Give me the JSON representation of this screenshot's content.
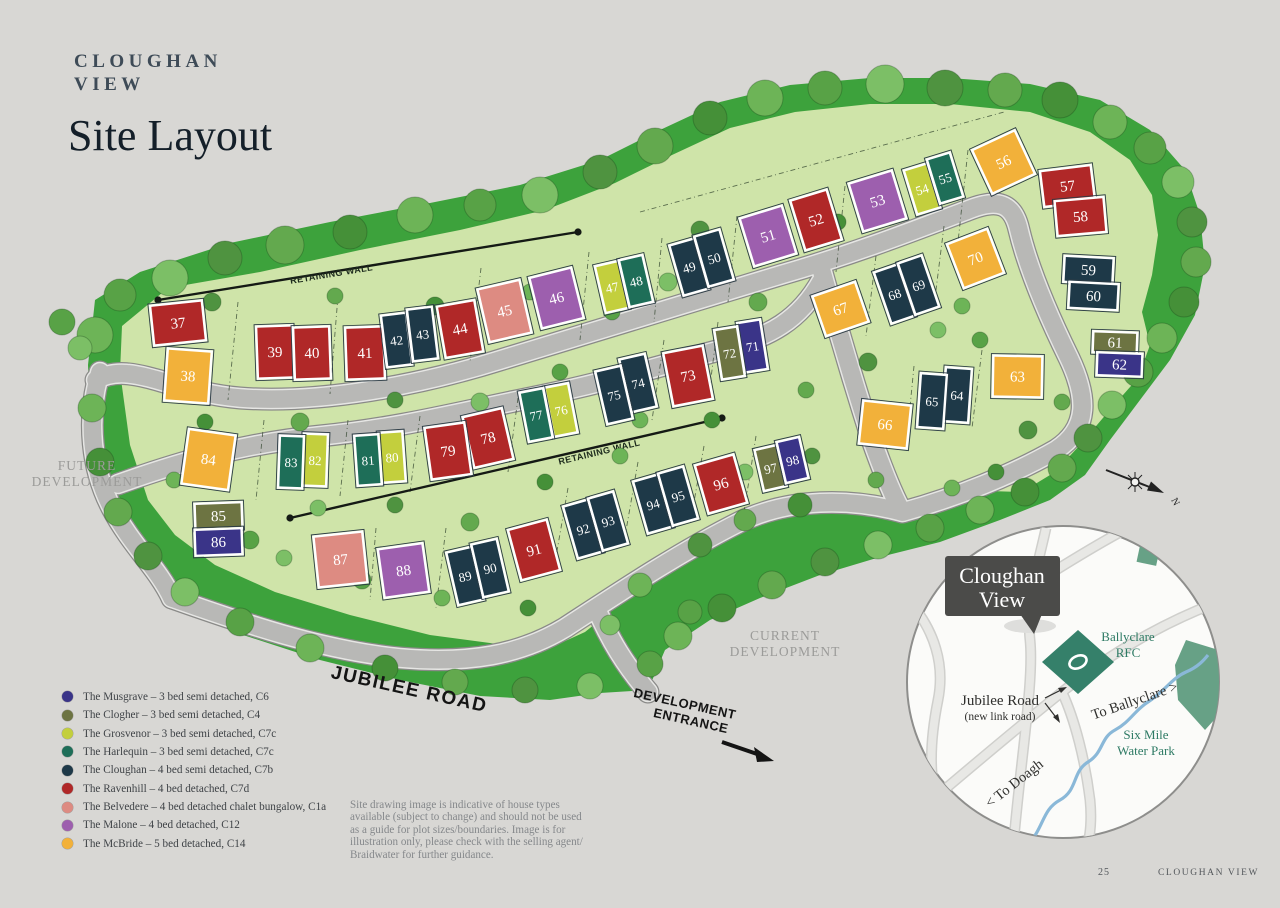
{
  "header": {
    "brand_line1": "CLOUGHAN",
    "brand_line2": "VIEW",
    "page_title": "Site Layout"
  },
  "site_labels": {
    "retaining_wall_upper": "RETAINING WALL",
    "retaining_wall_lower": "RETAINING WALL",
    "future_development_line1": "FUTURE",
    "future_development_line2": "DEVELOPMENT",
    "current_development_line1": "CURRENT",
    "current_development_line2": "DEVELOPMENT",
    "jubilee_road": "JUBILEE ROAD",
    "development_entrance_line1": "DEVELOPMENT",
    "development_entrance_line2": "ENTRANCE",
    "compass_north": "N"
  },
  "house_types": {
    "musgrave": {
      "label": "The Musgrave – 3 bed semi detached, C6",
      "color": "#3a3488"
    },
    "clogher": {
      "label": "The Clogher – 3 bed semi detached, C4",
      "color": "#6d7442"
    },
    "grosvenor": {
      "label": "The Grosvenor – 3 bed semi detached, C7c",
      "color": "#c3cf3d"
    },
    "harlequin": {
      "label": "The Harlequin – 3 bed semi detached, C7c",
      "color": "#1e6e58"
    },
    "cloughan": {
      "label": "The Cloughan – 4 bed semi detached, C7b",
      "color": "#1e3948"
    },
    "ravenhill": {
      "label": "The Ravenhill – 4 bed detached, C7d",
      "color": "#b02828"
    },
    "belvedere": {
      "label": "The Belvedere – 4 bed detached chalet bungalow, C1a",
      "color": "#dd8b82"
    },
    "malone": {
      "label": "The Malone – 4 bed detached, C12",
      "color": "#9d5fae"
    },
    "mcbride": {
      "label": "The McBride – 5 bed detached, C14",
      "color": "#f2b13a"
    }
  },
  "legend_order": [
    "musgrave",
    "clogher",
    "grosvenor",
    "harlequin",
    "cloughan",
    "ravenhill",
    "belvedere",
    "malone",
    "mcbride"
  ],
  "plots": [
    {
      "n": 37,
      "t": "ravenhill",
      "x": 152,
      "y": 303,
      "w": 52,
      "h": 40,
      "r": -6
    },
    {
      "n": 38,
      "t": "mcbride",
      "x": 166,
      "y": 350,
      "w": 44,
      "h": 52,
      "r": 4
    },
    {
      "n": 39,
      "t": "ravenhill",
      "x": 257,
      "y": 326,
      "w": 36,
      "h": 52,
      "r": -2
    },
    {
      "n": 40,
      "t": "ravenhill",
      "x": 294,
      "y": 327,
      "w": 36,
      "h": 52,
      "r": -2
    },
    {
      "n": 41,
      "t": "ravenhill",
      "x": 346,
      "y": 327,
      "w": 38,
      "h": 52,
      "r": -2
    },
    {
      "n": 42,
      "t": "cloughan",
      "x": 384,
      "y": 314,
      "w": 25,
      "h": 52,
      "r": -7
    },
    {
      "n": 43,
      "t": "cloughan",
      "x": 410,
      "y": 308,
      "w": 25,
      "h": 52,
      "r": -7
    },
    {
      "n": 44,
      "t": "ravenhill",
      "x": 441,
      "y": 303,
      "w": 38,
      "h": 52,
      "r": -10
    },
    {
      "n": 45,
      "t": "belvedere",
      "x": 483,
      "y": 284,
      "w": 43,
      "h": 54,
      "r": -13
    },
    {
      "n": 46,
      "t": "malone",
      "x": 535,
      "y": 272,
      "w": 43,
      "h": 52,
      "r": -14
    },
    {
      "n": 47,
      "t": "grosvenor",
      "x": 600,
      "y": 263,
      "w": 24,
      "h": 48,
      "r": -13
    },
    {
      "n": 48,
      "t": "harlequin",
      "x": 624,
      "y": 257,
      "w": 24,
      "h": 48,
      "r": -13
    },
    {
      "n": 49,
      "t": "cloughan",
      "x": 676,
      "y": 241,
      "w": 26,
      "h": 52,
      "r": -16
    },
    {
      "n": 50,
      "t": "cloughan",
      "x": 701,
      "y": 232,
      "w": 26,
      "h": 52,
      "r": -16
    },
    {
      "n": 51,
      "t": "malone",
      "x": 746,
      "y": 211,
      "w": 44,
      "h": 50,
      "r": -17
    },
    {
      "n": 52,
      "t": "ravenhill",
      "x": 797,
      "y": 194,
      "w": 38,
      "h": 52,
      "r": -17
    },
    {
      "n": 53,
      "t": "malone",
      "x": 855,
      "y": 176,
      "w": 45,
      "h": 50,
      "r": -17
    },
    {
      "n": 54,
      "t": "grosvenor",
      "x": 910,
      "y": 166,
      "w": 24,
      "h": 46,
      "r": -17
    },
    {
      "n": 55,
      "t": "harlequin",
      "x": 933,
      "y": 155,
      "w": 24,
      "h": 46,
      "r": -17
    },
    {
      "n": 56,
      "t": "mcbride",
      "x": 980,
      "y": 138,
      "w": 47,
      "h": 48,
      "r": -25
    },
    {
      "n": 57,
      "t": "ravenhill",
      "x": 1042,
      "y": 168,
      "w": 51,
      "h": 36,
      "r": -7
    },
    {
      "n": 58,
      "t": "ravenhill",
      "x": 1056,
      "y": 199,
      "w": 49,
      "h": 35,
      "r": -5
    },
    {
      "n": 59,
      "t": "cloughan",
      "x": 1064,
      "y": 257,
      "w": 49,
      "h": 26,
      "r": 3
    },
    {
      "n": 60,
      "t": "cloughan",
      "x": 1069,
      "y": 283,
      "w": 49,
      "h": 26,
      "r": 3
    },
    {
      "n": 61,
      "t": "clogher",
      "x": 1093,
      "y": 332,
      "w": 44,
      "h": 21,
      "r": 2
    },
    {
      "n": 62,
      "t": "musgrave",
      "x": 1097,
      "y": 353,
      "w": 45,
      "h": 23,
      "r": 2
    },
    {
      "n": 63,
      "t": "mcbride",
      "x": 993,
      "y": 356,
      "w": 49,
      "h": 41,
      "r": 1
    },
    {
      "n": 64,
      "t": "cloughan",
      "x": 944,
      "y": 368,
      "w": 26,
      "h": 54,
      "r": 4
    },
    {
      "n": 65,
      "t": "cloughan",
      "x": 919,
      "y": 374,
      "w": 26,
      "h": 54,
      "r": 4
    },
    {
      "n": 66,
      "t": "mcbride",
      "x": 861,
      "y": 403,
      "w": 48,
      "h": 43,
      "r": 6
    },
    {
      "n": 67,
      "t": "mcbride",
      "x": 818,
      "y": 288,
      "w": 45,
      "h": 42,
      "r": -19
    },
    {
      "n": 68,
      "t": "cloughan",
      "x": 882,
      "y": 267,
      "w": 25,
      "h": 54,
      "r": -19
    },
    {
      "n": 69,
      "t": "cloughan",
      "x": 906,
      "y": 258,
      "w": 25,
      "h": 54,
      "r": -19
    },
    {
      "n": 70,
      "t": "mcbride",
      "x": 954,
      "y": 235,
      "w": 43,
      "h": 47,
      "r": -21
    },
    {
      "n": 71,
      "t": "musgrave",
      "x": 741,
      "y": 321,
      "w": 23,
      "h": 50,
      "r": -9
    },
    {
      "n": 72,
      "t": "clogher",
      "x": 718,
      "y": 328,
      "w": 23,
      "h": 50,
      "r": -9
    },
    {
      "n": 73,
      "t": "ravenhill",
      "x": 668,
      "y": 349,
      "w": 40,
      "h": 54,
      "r": -11
    },
    {
      "n": 74,
      "t": "cloughan",
      "x": 625,
      "y": 356,
      "w": 26,
      "h": 54,
      "r": -13
    },
    {
      "n": 75,
      "t": "cloughan",
      "x": 601,
      "y": 368,
      "w": 26,
      "h": 54,
      "r": -13
    },
    {
      "n": 76,
      "t": "grosvenor",
      "x": 549,
      "y": 385,
      "w": 24,
      "h": 50,
      "r": -11
    },
    {
      "n": 77,
      "t": "harlequin",
      "x": 524,
      "y": 390,
      "w": 24,
      "h": 50,
      "r": -11
    },
    {
      "n": 78,
      "t": "ravenhill",
      "x": 468,
      "y": 412,
      "w": 40,
      "h": 52,
      "r": -13
    },
    {
      "n": 79,
      "t": "ravenhill",
      "x": 428,
      "y": 425,
      "w": 40,
      "h": 52,
      "r": -8
    },
    {
      "n": 80,
      "t": "grosvenor",
      "x": 380,
      "y": 432,
      "w": 24,
      "h": 50,
      "r": -4
    },
    {
      "n": 81,
      "t": "harlequin",
      "x": 356,
      "y": 435,
      "w": 24,
      "h": 50,
      "r": -4
    },
    {
      "n": 82,
      "t": "grosvenor",
      "x": 303,
      "y": 434,
      "w": 24,
      "h": 52,
      "r": 2
    },
    {
      "n": 83,
      "t": "harlequin",
      "x": 279,
      "y": 436,
      "w": 24,
      "h": 52,
      "r": 2
    },
    {
      "n": 84,
      "t": "mcbride",
      "x": 185,
      "y": 432,
      "w": 47,
      "h": 55,
      "r": 8
    },
    {
      "n": 85,
      "t": "clogher",
      "x": 195,
      "y": 503,
      "w": 47,
      "h": 26,
      "r": -2
    },
    {
      "n": 86,
      "t": "musgrave",
      "x": 195,
      "y": 529,
      "w": 47,
      "h": 26,
      "r": -2
    },
    {
      "n": 87,
      "t": "belvedere",
      "x": 316,
      "y": 534,
      "w": 49,
      "h": 51,
      "r": -6
    },
    {
      "n": 88,
      "t": "malone",
      "x": 381,
      "y": 546,
      "w": 45,
      "h": 49,
      "r": -8
    },
    {
      "n": 89,
      "t": "cloughan",
      "x": 452,
      "y": 549,
      "w": 26,
      "h": 54,
      "r": -13
    },
    {
      "n": 90,
      "t": "cloughan",
      "x": 477,
      "y": 541,
      "w": 26,
      "h": 54,
      "r": -13
    },
    {
      "n": 91,
      "t": "ravenhill",
      "x": 514,
      "y": 524,
      "w": 40,
      "h": 52,
      "r": -15
    },
    {
      "n": 92,
      "t": "cloughan",
      "x": 570,
      "y": 502,
      "w": 26,
      "h": 54,
      "r": -16
    },
    {
      "n": 93,
      "t": "cloughan",
      "x": 595,
      "y": 494,
      "w": 26,
      "h": 54,
      "r": -16
    },
    {
      "n": 94,
      "t": "cloughan",
      "x": 640,
      "y": 477,
      "w": 26,
      "h": 54,
      "r": -16
    },
    {
      "n": 95,
      "t": "cloughan",
      "x": 665,
      "y": 469,
      "w": 26,
      "h": 54,
      "r": -16
    },
    {
      "n": 96,
      "t": "ravenhill",
      "x": 701,
      "y": 459,
      "w": 40,
      "h": 50,
      "r": -16
    },
    {
      "n": 97,
      "t": "clogher",
      "x": 759,
      "y": 447,
      "w": 23,
      "h": 42,
      "r": -13
    },
    {
      "n": 98,
      "t": "musgrave",
      "x": 781,
      "y": 439,
      "w": 23,
      "h": 42,
      "r": -13
    }
  ],
  "disclaimer_lines": [
    "Site drawing image is indicative of house types",
    "available (subject to change) and should not be used",
    "as a guide for plot sizes/boundaries. Image is for",
    "illustration only, please check with the selling agent/",
    "Braidwater for further guidance."
  ],
  "inset_map": {
    "callout_line1": "Cloughan",
    "callout_line2": "View",
    "rfc_line1": "Ballyclare",
    "rfc_line2": "RFC",
    "road_label": "Jubilee Road",
    "road_sublabel": "(new link road)",
    "to_ballyclare": "To Ballyclare >",
    "to_doagh": "< To Doagh",
    "water_park_line1": "Six Mile",
    "water_park_line2": "Water Park"
  },
  "footer": {
    "page_number": "25",
    "brand": "CLOUGHAN VIEW"
  }
}
